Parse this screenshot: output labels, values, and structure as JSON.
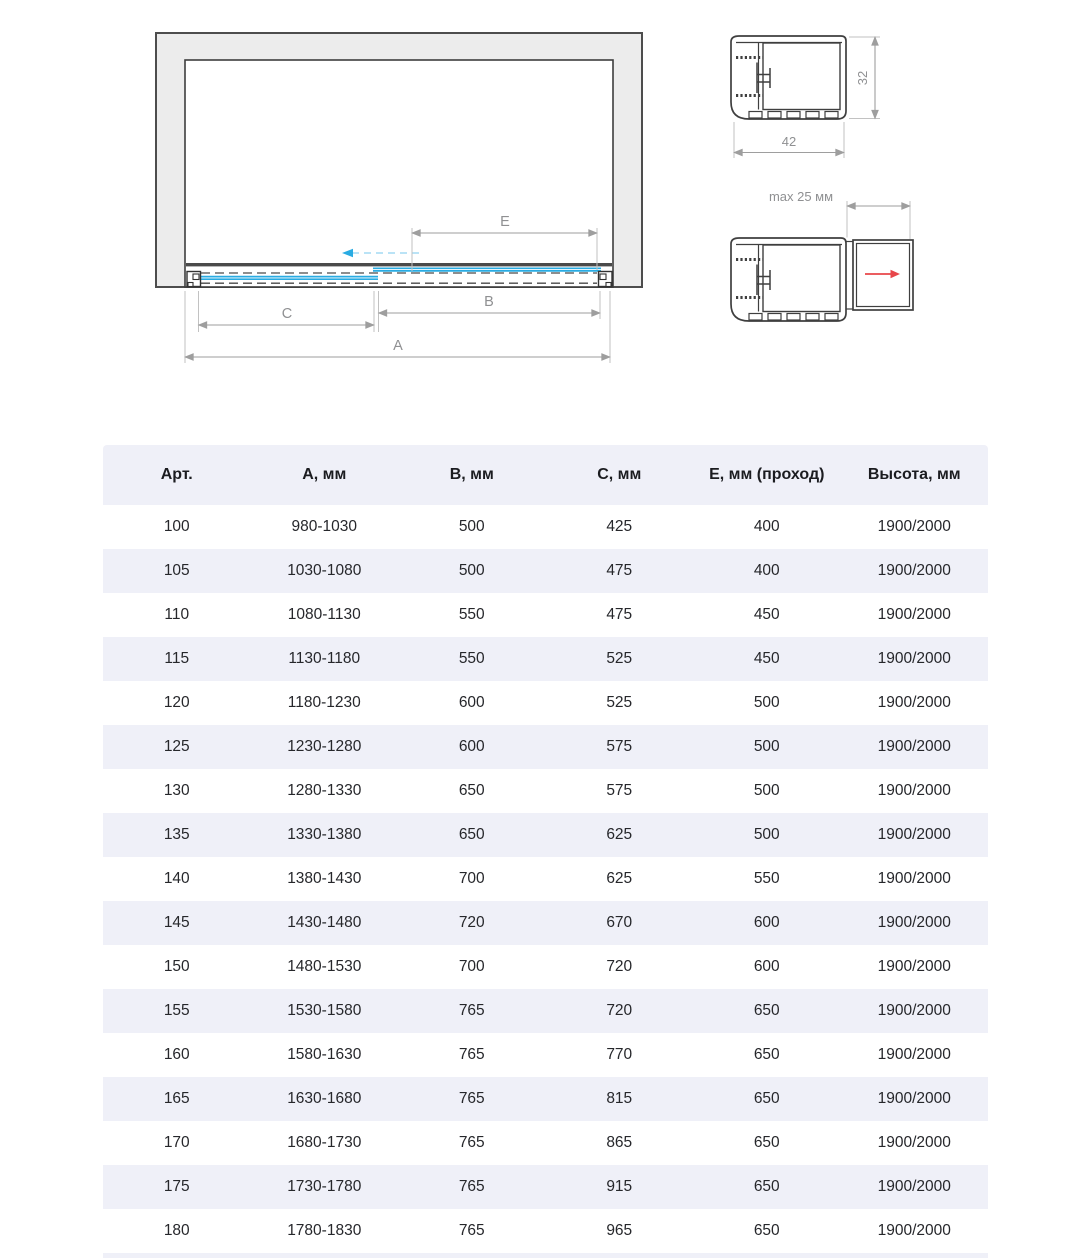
{
  "diagram": {
    "labels": {
      "a": "A",
      "b": "B",
      "c": "C",
      "e": "E"
    }
  },
  "profile_top": {
    "width": "42",
    "height": "32"
  },
  "profile_bottom": {
    "max_width": "max 25 мм"
  },
  "table": {
    "headers": [
      "Арт.",
      "А, мм",
      "В, мм",
      "С, мм",
      "Е, мм (проход)",
      "Высота, мм"
    ],
    "rows": [
      [
        "100",
        "980-1030",
        "500",
        "425",
        "400",
        "1900/2000"
      ],
      [
        "105",
        "1030-1080",
        "500",
        "475",
        "400",
        "1900/2000"
      ],
      [
        "110",
        "1080-1130",
        "550",
        "475",
        "450",
        "1900/2000"
      ],
      [
        "115",
        "1130-1180",
        "550",
        "525",
        "450",
        "1900/2000"
      ],
      [
        "120",
        "1180-1230",
        "600",
        "525",
        "500",
        "1900/2000"
      ],
      [
        "125",
        "1230-1280",
        "600",
        "575",
        "500",
        "1900/2000"
      ],
      [
        "130",
        "1280-1330",
        "650",
        "575",
        "500",
        "1900/2000"
      ],
      [
        "135",
        "1330-1380",
        "650",
        "625",
        "500",
        "1900/2000"
      ],
      [
        "140",
        "1380-1430",
        "700",
        "625",
        "550",
        "1900/2000"
      ],
      [
        "145",
        "1430-1480",
        "720",
        "670",
        "600",
        "1900/2000"
      ],
      [
        "150",
        "1480-1530",
        "700",
        "720",
        "600",
        "1900/2000"
      ],
      [
        "155",
        "1530-1580",
        "765",
        "720",
        "650",
        "1900/2000"
      ],
      [
        "160",
        "1580-1630",
        "765",
        "770",
        "650",
        "1900/2000"
      ],
      [
        "165",
        "1630-1680",
        "765",
        "815",
        "650",
        "1900/2000"
      ],
      [
        "170",
        "1680-1730",
        "765",
        "865",
        "650",
        "1900/2000"
      ],
      [
        "175",
        "1730-1780",
        "765",
        "915",
        "650",
        "1900/2000"
      ],
      [
        "180",
        "1780-1830",
        "765",
        "965",
        "650",
        "1900/2000"
      ]
    ]
  },
  "colors": {
    "glass_blue": "#29abe2",
    "arrow_red": "#e8464a",
    "band": "#eff0f8",
    "wall_fill": "#ececec"
  }
}
